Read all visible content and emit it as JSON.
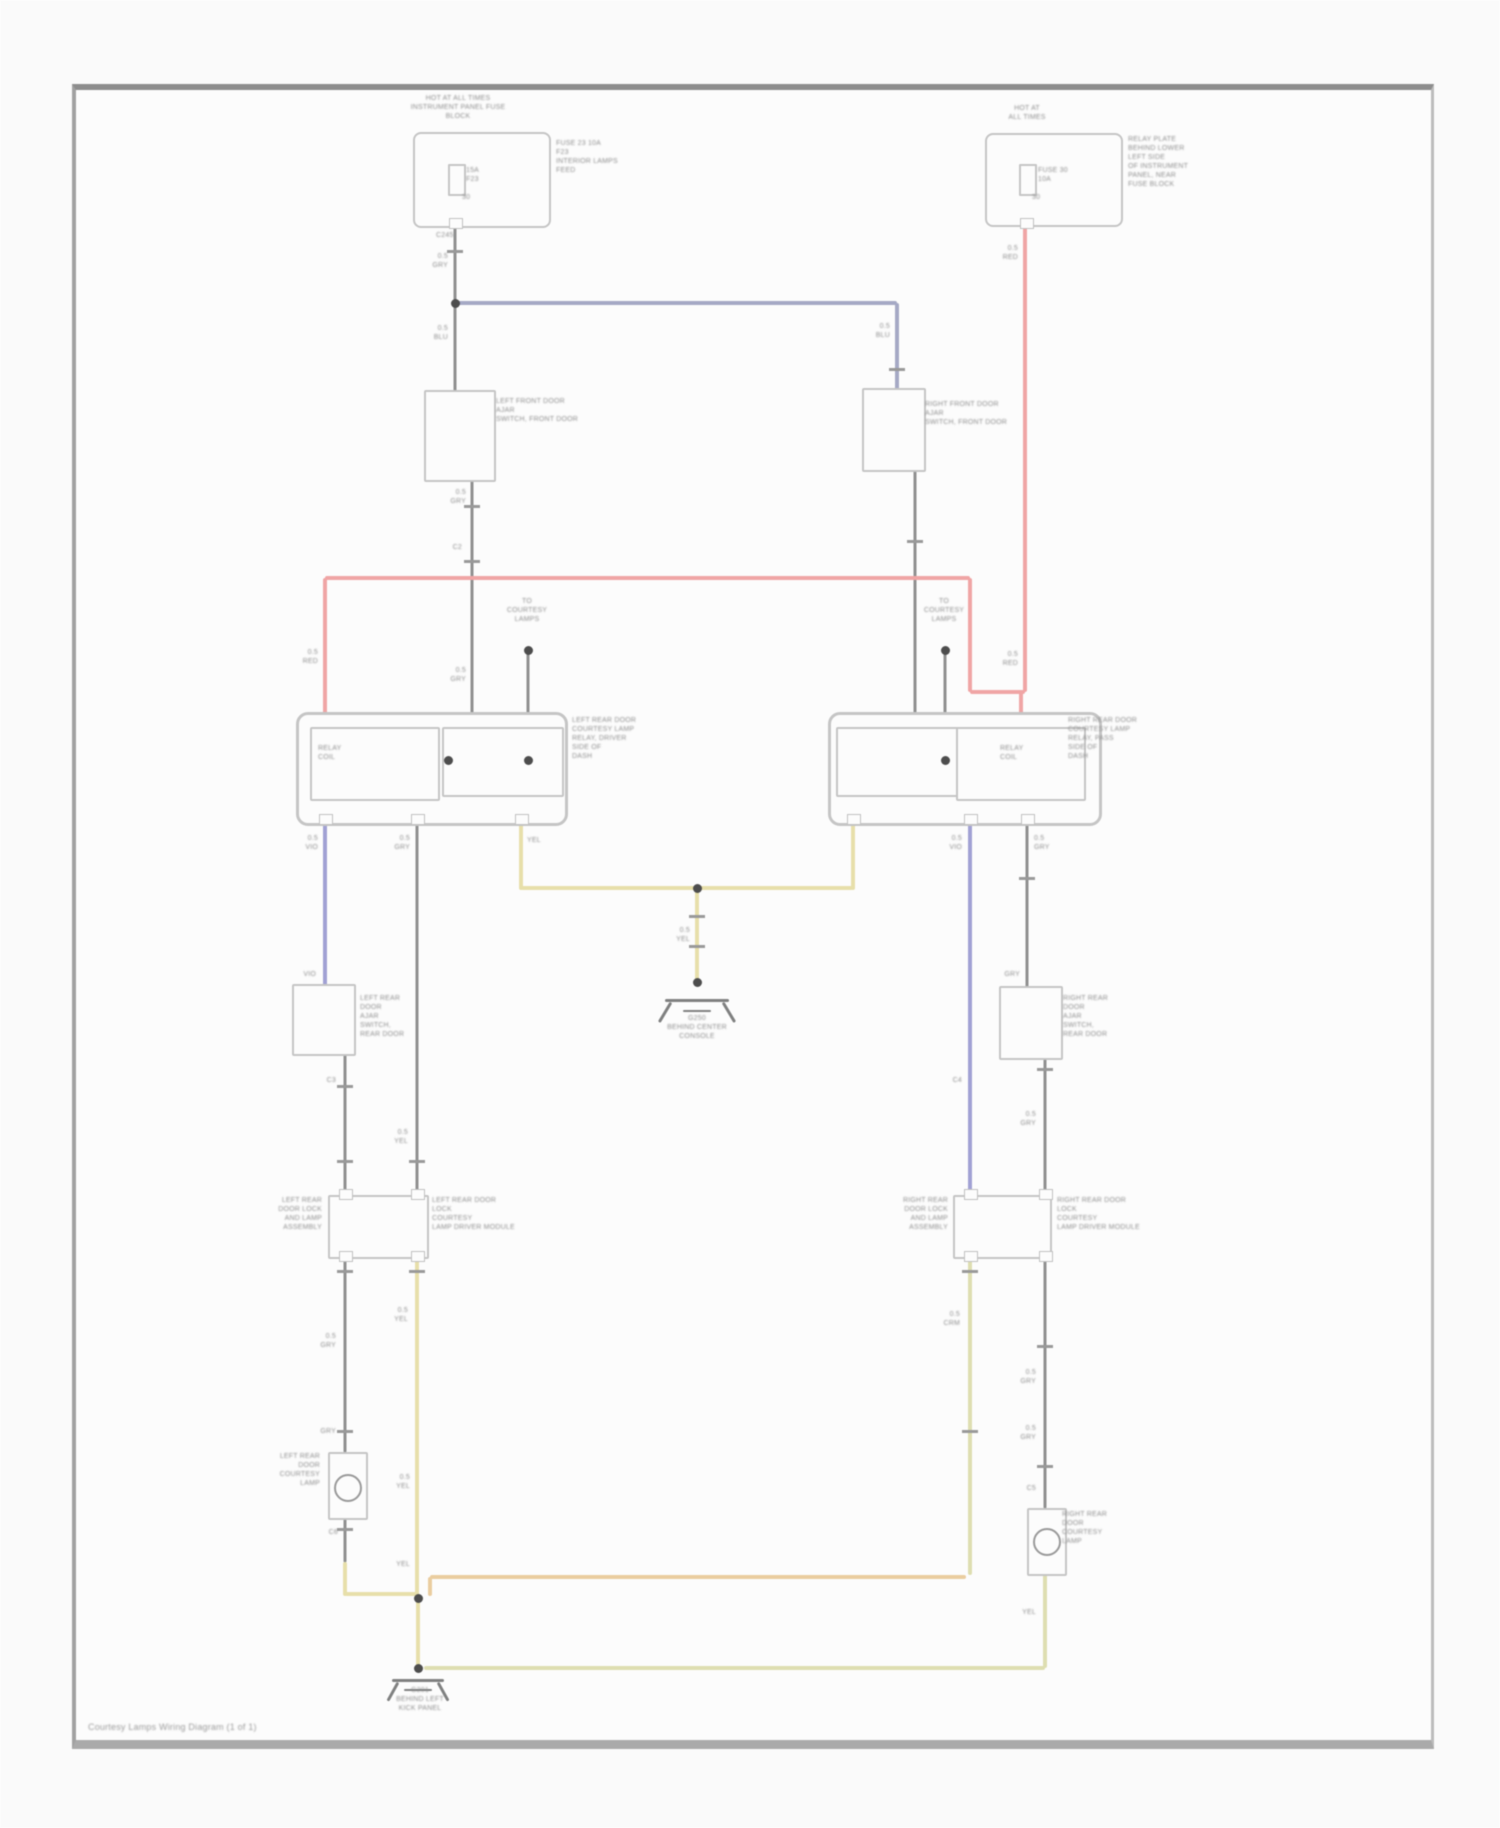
{
  "page": {
    "caption": "Courtesy Lamps Wiring Diagram (1 of 1)",
    "frame": {
      "x": 72,
      "y": 84,
      "w": 1355,
      "h": 1650
    }
  },
  "colors": {
    "gray": "#8f9090",
    "red": "#f2a6a6",
    "blue": "#a6aac6",
    "violet": "#a2a2d6",
    "yellow": "#e9e1ab",
    "amber": "#eccfa0",
    "cream": "#e0e0b2",
    "blade": "#7f8080",
    "box": "#c6c6c6",
    "dot": "#4c4c4c",
    "text": "#8e8e8e",
    "tick": "#9a9a9a"
  },
  "wires": [
    [
      455,
      224,
      455,
      303,
      "gray",
      3
    ],
    [
      455,
      303,
      455,
      398,
      "gray",
      3
    ],
    [
      472,
      460,
      472,
      714,
      "gray",
      3
    ],
    [
      528,
      652,
      528,
      714,
      "gray",
      3
    ],
    [
      915,
      456,
      915,
      714,
      "gray",
      3
    ],
    [
      945,
      652,
      945,
      714,
      "gray",
      3
    ],
    [
      417,
      820,
      417,
      1195,
      "gray",
      3
    ],
    [
      345,
      1050,
      345,
      1195,
      "gray",
      3
    ],
    [
      345,
      1255,
      345,
      1452,
      "gray",
      3
    ],
    [
      345,
      1516,
      345,
      1562,
      "gray",
      3
    ],
    [
      1027,
      820,
      1027,
      988,
      "gray",
      3
    ],
    [
      1045,
      1055,
      1045,
      1195,
      "gray",
      3
    ],
    [
      1045,
      1255,
      1045,
      1508,
      "gray",
      3
    ],
    [
      455,
      303,
      897,
      303,
      "blue",
      4
    ],
    [
      897,
      303,
      897,
      392,
      "blue",
      4
    ],
    [
      325,
      578,
      970,
      578,
      "red",
      4
    ],
    [
      325,
      578,
      325,
      714,
      "red",
      4
    ],
    [
      970,
      578,
      970,
      692,
      "red",
      4
    ],
    [
      970,
      692,
      1025,
      692,
      "red",
      4
    ],
    [
      1025,
      224,
      1025,
      692,
      "red",
      4
    ],
    [
      1021,
      692,
      1021,
      714,
      "red",
      4
    ],
    [
      325,
      820,
      325,
      986,
      "violet",
      4
    ],
    [
      970,
      820,
      970,
      1195,
      "violet",
      4
    ],
    [
      521,
      820,
      521,
      890,
      "yellow",
      4
    ],
    [
      853,
      820,
      853,
      890,
      "yellow",
      4
    ],
    [
      521,
      888,
      853,
      888,
      "yellow",
      4
    ],
    [
      697,
      888,
      697,
      982,
      "yellow",
      4
    ],
    [
      417,
      1255,
      417,
      1598,
      "yellow",
      4
    ],
    [
      345,
      1562,
      345,
      1596,
      "yellow",
      4
    ],
    [
      345,
      1594,
      418,
      1594,
      "yellow",
      4
    ],
    [
      418,
      1598,
      418,
      1668,
      "yellow",
      4
    ],
    [
      430,
      1577,
      966,
      1577,
      "amber",
      4
    ],
    [
      430,
      1577,
      430,
      1596,
      "amber",
      4
    ],
    [
      970,
      1255,
      970,
      1575,
      "cream",
      4
    ],
    [
      424,
      1668,
      1045,
      1668,
      "cream",
      4
    ],
    [
      1045,
      1572,
      1045,
      1668,
      "cream",
      4
    ],
    [
      448,
      150,
      448,
      222,
      "box",
      2
    ],
    [
      448,
      150,
      545,
      150,
      "box",
      2
    ],
    [
      1012,
      150,
      1012,
      221,
      "box",
      2
    ],
    [
      1012,
      150,
      1117,
      150,
      "box",
      2
    ],
    [
      665,
      1000,
      729,
      1000,
      "blade",
      3
    ],
    [
      683,
      1011,
      711,
      1011,
      "blade",
      2
    ],
    [
      392,
      1680,
      444,
      1680,
      "blade",
      3
    ],
    [
      404,
      1690,
      432,
      1690,
      "blade",
      2
    ]
  ],
  "blades": [
    [
      455,
      398,
      477,
      460
    ],
    [
      897,
      398,
      917,
      456
    ],
    [
      325,
      992,
      346,
      1048
    ],
    [
      1027,
      994,
      1046,
      1052
    ],
    [
      472,
      733,
      522,
      786
    ],
    [
      915,
      733,
      866,
      786
    ],
    [
      393,
      728,
      393,
      742
    ],
    [
      393,
      742,
      374,
      776
    ],
    [
      985,
      728,
      985,
      742
    ],
    [
      985,
      742,
      1003,
      776
    ],
    [
      671,
      1002,
      659,
      1022
    ],
    [
      723,
      1002,
      735,
      1022
    ],
    [
      398,
      1682,
      388,
      1700
    ],
    [
      438,
      1682,
      448,
      1700
    ]
  ],
  "boxes": [
    {
      "x": 413,
      "y": 132,
      "w": 134,
      "h": 92,
      "b": 2,
      "r": 8,
      "name": "fuse-block-box"
    },
    {
      "x": 985,
      "y": 133,
      "w": 134,
      "h": 90,
      "b": 2,
      "r": 8,
      "name": "junction-box"
    },
    {
      "x": 448,
      "y": 164,
      "w": 14,
      "h": 28,
      "b": 2,
      "r": 1,
      "name": "fuse-left"
    },
    {
      "x": 1019,
      "y": 164,
      "w": 14,
      "h": 28,
      "b": 2,
      "r": 1,
      "name": "fuse-right"
    },
    {
      "x": 424,
      "y": 390,
      "w": 68,
      "h": 88,
      "b": 2,
      "r": 2,
      "name": "left-front-door-switch-box"
    },
    {
      "x": 862,
      "y": 388,
      "w": 60,
      "h": 80,
      "b": 2,
      "r": 2,
      "name": "right-front-door-switch-box"
    },
    {
      "x": 296,
      "y": 712,
      "w": 266,
      "h": 108,
      "b": 3,
      "r": 12,
      "name": "left-relay-box"
    },
    {
      "x": 310,
      "y": 727,
      "w": 126,
      "h": 70,
      "b": 2,
      "r": 2,
      "name": "left-relay-coil-box"
    },
    {
      "x": 442,
      "y": 727,
      "w": 118,
      "h": 66,
      "b": 2,
      "r": 2,
      "name": "left-relay-switch-box"
    },
    {
      "x": 828,
      "y": 712,
      "w": 268,
      "h": 108,
      "b": 3,
      "r": 12,
      "name": "right-relay-box"
    },
    {
      "x": 836,
      "y": 727,
      "w": 120,
      "h": 66,
      "b": 2,
      "r": 2,
      "name": "right-relay-switch-box"
    },
    {
      "x": 956,
      "y": 727,
      "w": 126,
      "h": 70,
      "b": 2,
      "r": 2,
      "name": "right-relay-coil-box"
    },
    {
      "x": 292,
      "y": 984,
      "w": 60,
      "h": 68,
      "b": 2,
      "r": 2,
      "name": "left-rear-door-switch-box"
    },
    {
      "x": 999,
      "y": 986,
      "w": 60,
      "h": 70,
      "b": 2,
      "r": 2,
      "name": "right-rear-door-switch-box"
    },
    {
      "x": 328,
      "y": 1195,
      "w": 97,
      "h": 60,
      "b": 2,
      "r": 2,
      "name": "left-door-module-box"
    },
    {
      "x": 953,
      "y": 1195,
      "w": 95,
      "h": 60,
      "b": 2,
      "r": 2,
      "name": "right-door-module-box"
    },
    {
      "x": 328,
      "y": 1452,
      "w": 36,
      "h": 64,
      "b": 2,
      "r": 2,
      "name": "left-lamp-box"
    },
    {
      "x": 1027,
      "y": 1508,
      "w": 36,
      "h": 64,
      "b": 2,
      "r": 2,
      "name": "right-lamp-box"
    }
  ],
  "lamps": [
    [
      346,
      1486
    ],
    [
      1045,
      1540
    ]
  ],
  "dots": [
    [
      455,
      303
    ],
    [
      528,
      650
    ],
    [
      945,
      650
    ],
    [
      448,
      760
    ],
    [
      528,
      760
    ],
    [
      945,
      760
    ],
    [
      697,
      888
    ],
    [
      697,
      982
    ],
    [
      418,
      1598
    ],
    [
      418,
      1668
    ]
  ],
  "ticks": [
    [
      455,
      250
    ],
    [
      472,
      505
    ],
    [
      472,
      560
    ],
    [
      897,
      368
    ],
    [
      915,
      540
    ],
    [
      345,
      1085
    ],
    [
      345,
      1160
    ],
    [
      417,
      1160
    ],
    [
      697,
      915
    ],
    [
      697,
      945
    ],
    [
      345,
      1270
    ],
    [
      417,
      1270
    ],
    [
      345,
      1430
    ],
    [
      345,
      1528
    ],
    [
      970,
      1270
    ],
    [
      1045,
      1068
    ],
    [
      1045,
      1345
    ],
    [
      1045,
      1465
    ],
    [
      1027,
      877
    ],
    [
      970,
      1430
    ]
  ],
  "nubs": [
    [
      319,
      814
    ],
    [
      411,
      814
    ],
    [
      515,
      814
    ],
    [
      847,
      814
    ],
    [
      964,
      814
    ],
    [
      1021,
      814
    ],
    [
      339,
      1189
    ],
    [
      411,
      1189
    ],
    [
      964,
      1189
    ],
    [
      1039,
      1189
    ],
    [
      339,
      1251
    ],
    [
      411,
      1251
    ],
    [
      964,
      1251
    ],
    [
      1039,
      1251
    ],
    [
      449,
      218
    ],
    [
      1020,
      218
    ]
  ],
  "labels": [
    {
      "a": "c",
      "x": 458,
      "y": 94,
      "t": [
        "HOT AT ALL TIMES",
        "INSTRUMENT PANEL FUSE",
        "BLOCK"
      ]
    },
    {
      "a": "l",
      "x": 556,
      "y": 139,
      "t": [
        "FUSE 23 10A",
        "F23",
        "INTERIOR LAMPS",
        "FEED"
      ]
    },
    {
      "a": "l",
      "x": 466,
      "y": 166,
      "t": [
        "15A",
        "F23"
      ]
    },
    {
      "a": "l",
      "x": 462,
      "y": 193,
      "t": [
        "30"
      ]
    },
    {
      "a": "c",
      "x": 1027,
      "y": 104,
      "t": [
        "HOT AT",
        "ALL TIMES"
      ]
    },
    {
      "a": "l",
      "x": 1128,
      "y": 135,
      "t": [
        "RELAY PLATE",
        "BEHIND LOWER",
        "LEFT SIDE",
        "OF INSTRUMENT",
        "PANEL, NEAR",
        "FUSE BLOCK"
      ]
    },
    {
      "a": "l",
      "x": 1038,
      "y": 166,
      "t": [
        "FUSE 30",
        "10A"
      ]
    },
    {
      "a": "l",
      "x": 1032,
      "y": 193,
      "t": [
        "30"
      ]
    },
    {
      "a": "r",
      "x": 1018,
      "y": 244,
      "t": [
        "0.5",
        "RED"
      ]
    },
    {
      "a": "l",
      "x": 436,
      "y": 231,
      "t": [
        "C245"
      ]
    },
    {
      "a": "r",
      "x": 448,
      "y": 252,
      "t": [
        "0.5",
        "GRY"
      ]
    },
    {
      "a": "r",
      "x": 448,
      "y": 324,
      "t": [
        "0.5",
        "BLU"
      ]
    },
    {
      "a": "r",
      "x": 890,
      "y": 322,
      "t": [
        "0.5",
        "BLU"
      ]
    },
    {
      "a": "l",
      "x": 496,
      "y": 397,
      "t": [
        "LEFT FRONT DOOR",
        "AJAR",
        "SWITCH, FRONT DOOR"
      ]
    },
    {
      "a": "l",
      "x": 925,
      "y": 400,
      "t": [
        "RIGHT FRONT DOOR",
        "AJAR",
        "SWITCH, FRONT DOOR"
      ]
    },
    {
      "a": "r",
      "x": 466,
      "y": 488,
      "t": [
        "0.5",
        "GRY"
      ]
    },
    {
      "a": "r",
      "x": 462,
      "y": 543,
      "t": [
        "C2"
      ]
    },
    {
      "a": "r",
      "x": 466,
      "y": 666,
      "t": [
        "0.5",
        "GRY"
      ]
    },
    {
      "a": "r",
      "x": 318,
      "y": 648,
      "t": [
        "0.5",
        "RED"
      ]
    },
    {
      "a": "r",
      "x": 1018,
      "y": 650,
      "t": [
        "0.5",
        "RED"
      ]
    },
    {
      "a": "c",
      "x": 527,
      "y": 597,
      "t": [
        "TO",
        "COURTESY",
        "LAMPS"
      ]
    },
    {
      "a": "c",
      "x": 944,
      "y": 597,
      "t": [
        "TO",
        "COURTESY",
        "LAMPS"
      ]
    },
    {
      "a": "l",
      "x": 318,
      "y": 744,
      "t": [
        "RELAY",
        "COIL"
      ]
    },
    {
      "a": "l",
      "x": 1000,
      "y": 744,
      "t": [
        "RELAY",
        "COIL"
      ]
    },
    {
      "a": "l",
      "x": 572,
      "y": 716,
      "t": [
        "LEFT REAR DOOR",
        "COURTESY LAMP",
        "RELAY, DRIVER",
        "SIDE OF",
        "DASH"
      ]
    },
    {
      "a": "l",
      "x": 1068,
      "y": 716,
      "t": [
        "RIGHT REAR DOOR",
        "COURTESY LAMP",
        "RELAY, PASS",
        "SIDE OF",
        "DASH"
      ]
    },
    {
      "a": "r",
      "x": 318,
      "y": 834,
      "t": [
        "0.5",
        "VIO"
      ]
    },
    {
      "a": "r",
      "x": 410,
      "y": 834,
      "t": [
        "0.5",
        "GRY"
      ]
    },
    {
      "a": "l",
      "x": 527,
      "y": 836,
      "t": [
        "YEL"
      ]
    },
    {
      "a": "r",
      "x": 962,
      "y": 834,
      "t": [
        "0.5",
        "VIO"
      ]
    },
    {
      "a": "l",
      "x": 1034,
      "y": 834,
      "t": [
        "0.5",
        "GRY"
      ]
    },
    {
      "a": "r",
      "x": 690,
      "y": 926,
      "t": [
        "0.5",
        "YEL"
      ]
    },
    {
      "a": "c",
      "x": 697,
      "y": 1014,
      "t": [
        "G250",
        "BEHIND CENTER",
        "CONSOLE"
      ]
    },
    {
      "a": "l",
      "x": 360,
      "y": 994,
      "t": [
        "LEFT REAR",
        "DOOR",
        "AJAR",
        "SWITCH,",
        "REAR DOOR"
      ]
    },
    {
      "a": "r",
      "x": 316,
      "y": 970,
      "t": [
        "VIO"
      ]
    },
    {
      "a": "l",
      "x": 1063,
      "y": 994,
      "t": [
        "RIGHT REAR",
        "DOOR",
        "AJAR",
        "SWITCH,",
        "REAR DOOR"
      ]
    },
    {
      "a": "r",
      "x": 1020,
      "y": 970,
      "t": [
        "GRY"
      ]
    },
    {
      "a": "r",
      "x": 336,
      "y": 1076,
      "t": [
        "C3"
      ]
    },
    {
      "a": "r",
      "x": 336,
      "y": 1332,
      "t": [
        "0.5",
        "GRY"
      ]
    },
    {
      "a": "r",
      "x": 408,
      "y": 1128,
      "t": [
        "0.5",
        "YEL"
      ]
    },
    {
      "a": "r",
      "x": 408,
      "y": 1306,
      "t": [
        "0.5",
        "YEL"
      ]
    },
    {
      "a": "r",
      "x": 322,
      "y": 1196,
      "t": [
        "LEFT REAR",
        "DOOR LOCK",
        "AND LAMP",
        "ASSEMBLY"
      ]
    },
    {
      "a": "l",
      "x": 432,
      "y": 1196,
      "t": [
        "LEFT REAR DOOR",
        "LOCK",
        "COURTESY",
        "LAMP DRIVER MODULE"
      ]
    },
    {
      "a": "r",
      "x": 948,
      "y": 1196,
      "t": [
        "RIGHT REAR",
        "DOOR LOCK",
        "AND LAMP",
        "ASSEMBLY"
      ]
    },
    {
      "a": "l",
      "x": 1057,
      "y": 1196,
      "t": [
        "RIGHT REAR DOOR",
        "LOCK",
        "COURTESY",
        "LAMP DRIVER MODULE"
      ]
    },
    {
      "a": "r",
      "x": 962,
      "y": 1076,
      "t": [
        "C4"
      ]
    },
    {
      "a": "r",
      "x": 960,
      "y": 1310,
      "t": [
        "0.5",
        "CRM"
      ]
    },
    {
      "a": "r",
      "x": 1036,
      "y": 1110,
      "t": [
        "0.5",
        "GRY"
      ]
    },
    {
      "a": "r",
      "x": 1036,
      "y": 1368,
      "t": [
        "0.5",
        "GRY"
      ]
    },
    {
      "a": "r",
      "x": 1036,
      "y": 1424,
      "t": [
        "0.5",
        "GRY"
      ]
    },
    {
      "a": "r",
      "x": 1036,
      "y": 1484,
      "t": [
        "C5"
      ]
    },
    {
      "a": "r",
      "x": 320,
      "y": 1452,
      "t": [
        "LEFT REAR",
        "DOOR",
        "COURTESY",
        "LAMP"
      ]
    },
    {
      "a": "r",
      "x": 336,
      "y": 1427,
      "t": [
        "GRY"
      ]
    },
    {
      "a": "r",
      "x": 338,
      "y": 1528,
      "t": [
        "C6"
      ]
    },
    {
      "a": "r",
      "x": 410,
      "y": 1473,
      "t": [
        "0.5",
        "YEL"
      ]
    },
    {
      "a": "r",
      "x": 410,
      "y": 1560,
      "t": [
        "YEL"
      ]
    },
    {
      "a": "l",
      "x": 1062,
      "y": 1510,
      "t": [
        "RIGHT REAR",
        "DOOR",
        "COURTESY",
        "LAMP"
      ]
    },
    {
      "a": "r",
      "x": 1036,
      "y": 1608,
      "t": [
        "YEL"
      ]
    },
    {
      "a": "c",
      "x": 420,
      "y": 1686,
      "t": [
        "G201",
        "BEHIND LEFT",
        "KICK PANEL"
      ]
    }
  ]
}
